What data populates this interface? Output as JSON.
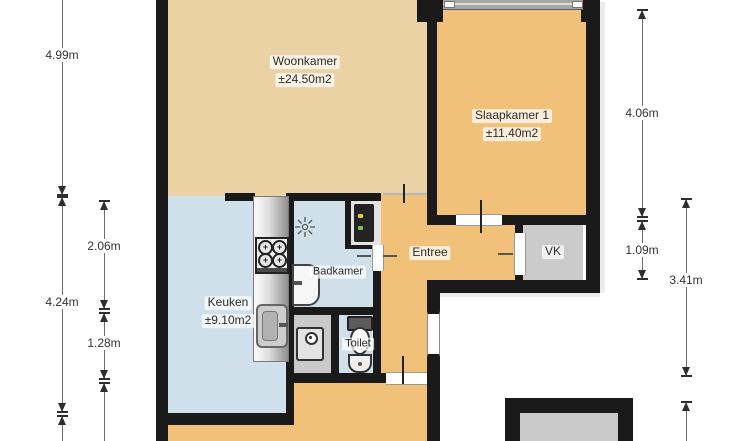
{
  "rooms": {
    "woonkamer": {
      "label": "Woonkamer",
      "area": "±24.50m2"
    },
    "slaapkamer1": {
      "label": "Slaapkamer 1",
      "area": "±11.40m2"
    },
    "keuken": {
      "label": "Keuken",
      "area": "±9.10m2"
    },
    "badkamer": {
      "label": "Badkamer"
    },
    "entree": {
      "label": "Entree"
    },
    "vk": {
      "label": "VK"
    },
    "toilet": {
      "label": "Toilet"
    }
  },
  "dimensions": {
    "left_outer": [
      "4.99m",
      "4.24m"
    ],
    "left_inner": [
      "2.06m",
      "1.28m"
    ],
    "right_inner": [
      "4.06m",
      "1.09m"
    ],
    "right_outer": [
      "3.41m"
    ]
  },
  "colors": {
    "wall": "#1a1a1a",
    "floor_living": "#ebd2a4",
    "floor_bedroom_hall": "#f1c179",
    "floor_wet_rooms": "#cfe0ea",
    "floor_storage_gray": "#cbcbcb",
    "background": "#ffffff"
  }
}
